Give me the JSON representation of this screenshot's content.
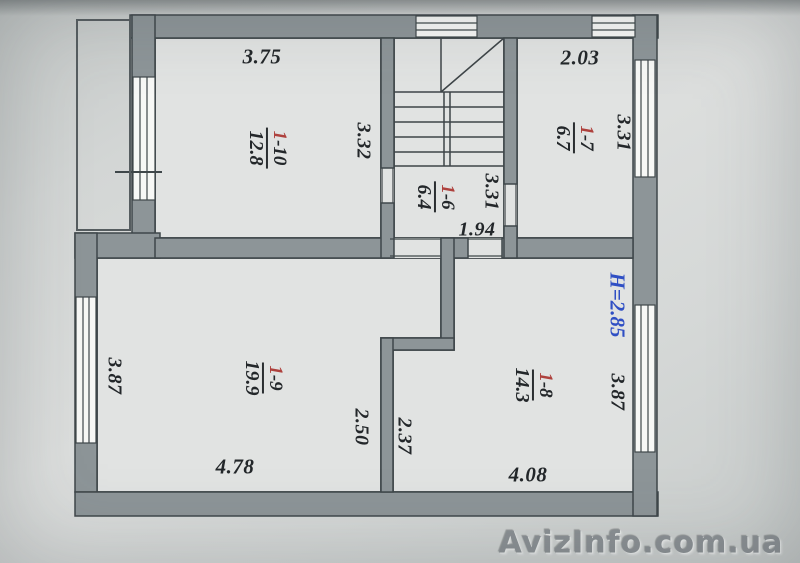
{
  "photo": {
    "watermark": "AvizInfo.com.ua"
  },
  "plan": {
    "height_label": "H=2.85",
    "rooms": {
      "r110": {
        "num": "1",
        "rest": "-10",
        "area": "12.8"
      },
      "r17": {
        "num": "1",
        "rest": "-7",
        "area": "6.7"
      },
      "r16": {
        "num": "1",
        "rest": "-6",
        "area": "6.4"
      },
      "r19": {
        "num": "1",
        "rest": "-9",
        "area": "19.9"
      },
      "r18": {
        "num": "1",
        "rest": "-8",
        "area": "14.3"
      }
    },
    "dims": {
      "top_room_width": "3.75",
      "top_room_height": "3.32",
      "right_room_width": "2.03",
      "right_room_height": "3.31",
      "hall_height": "3.31",
      "hall_width": "1.94",
      "living_height": "3.87",
      "living_width": "4.78",
      "living_inner": "2.50",
      "bottom_right_inner": "2.37",
      "bottom_right_width": "4.08",
      "bottom_right_height": "3.87"
    },
    "colors": {
      "wall": "#8d9598",
      "room": "#e1e3e2",
      "accent_red": "#ae413d",
      "accent_blue": "#2f4fc4"
    }
  }
}
